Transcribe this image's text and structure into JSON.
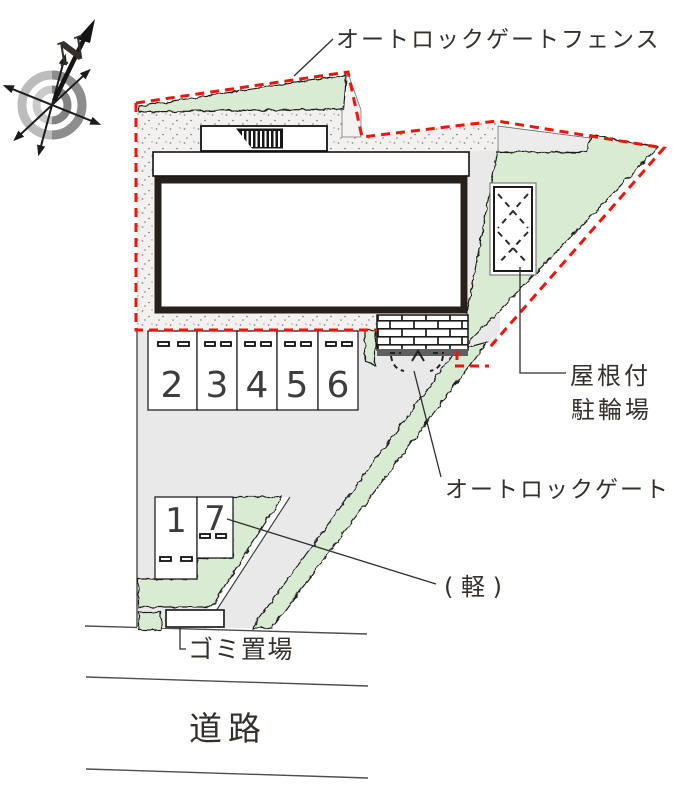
{
  "labels": {
    "fence": "オートロックゲートフェンス",
    "gate": "オートロックゲート",
    "bike_line1": "屋根付",
    "bike_line2": "駐輪場",
    "kei": "( 軽 )",
    "garbage": "ゴミ置場",
    "road": "道路",
    "north": "N"
  },
  "parking": {
    "main_row": [
      "2",
      "3",
      "4",
      "5",
      "6"
    ],
    "front_row": [
      "1",
      "7"
    ]
  },
  "colors": {
    "boundary_red": "#f41309",
    "hedge_green": "#d9ebd2",
    "paving_gray": "#e9e9e9",
    "stipple_gray": "#f2f1ef",
    "building_outline": "#261f1a"
  }
}
